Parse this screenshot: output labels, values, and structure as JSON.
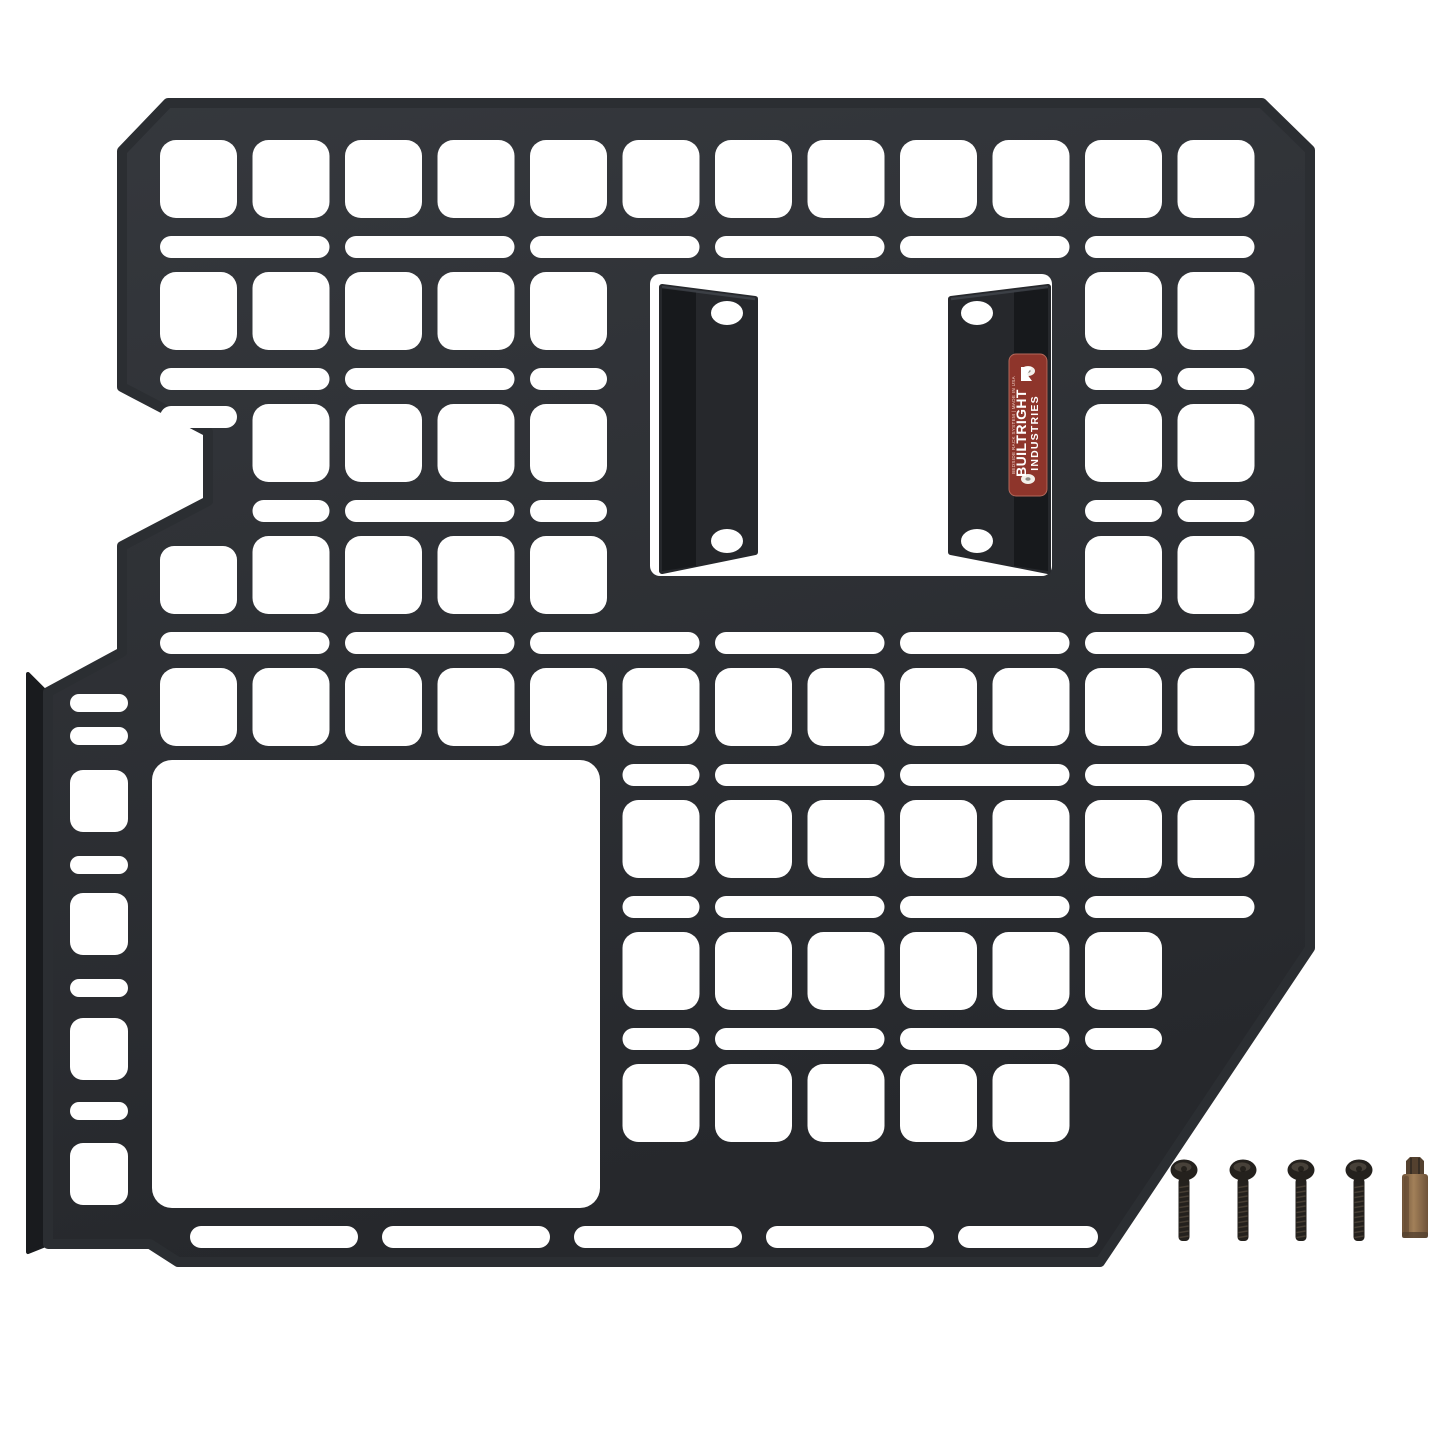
{
  "scene": {
    "alt": "Black laser-cut MOLLE bedside rack panel with two mounting brackets, red BuiltRight Industries badge, four black screws and one Torx bit on a white background",
    "bg": "#ffffff",
    "width": 1445,
    "height": 1444
  },
  "colors": {
    "panel_top": "#35383d",
    "panel_bottom": "#26282c",
    "panel_stroke": "#2b2e32",
    "flange": "#191b1e",
    "bracket": "#26282c",
    "bracket_web": "#17191c",
    "bracket_edge": "#474c53",
    "cutout": "#ffffff",
    "badge_bg": "#8e352b",
    "badge_border": "#b4685a",
    "badge_text": "#ffffff",
    "badge_smallprint": "#eecfc6",
    "rivet": "#f2efe9",
    "rivet_center": "#8e8a84",
    "screw": "#24211d",
    "screw_hl": "#6a6156",
    "screw_recess": "#0d0c0a",
    "thread": "#4e4438",
    "bit_light": "#a28059",
    "bit_dark": "#6e5238",
    "bit_tip": "#54412f",
    "bit_shade": "#5f4630"
  },
  "panel": {
    "outline": [
      [
        168,
        103
      ],
      [
        1262,
        103
      ],
      [
        1310,
        150
      ],
      [
        1310,
        948
      ],
      [
        1100,
        1262
      ],
      [
        178,
        1262
      ],
      [
        150,
        1244
      ],
      [
        48,
        1244
      ],
      [
        48,
        692
      ],
      [
        122,
        652
      ],
      [
        122,
        546
      ],
      [
        208,
        501
      ],
      [
        208,
        432
      ],
      [
        122,
        387
      ],
      [
        122,
        151
      ]
    ],
    "flange": [
      [
        28,
        674
      ],
      [
        48,
        694
      ],
      [
        48,
        1244
      ],
      [
        28,
        1252
      ]
    ]
  },
  "grid": {
    "col_x0": 160,
    "col_pitch": 92.5,
    "sq_w": 77,
    "sq_h": 78,
    "sq_r": 16,
    "slot_h": 22,
    "slot_r": 11,
    "pair_w": 169.5,
    "square_rows": [
      {
        "y": 140,
        "cols": [
          1,
          2,
          3,
          4,
          5,
          6,
          7,
          8,
          9,
          10,
          11,
          12
        ]
      },
      {
        "y": 272,
        "cols": [
          1,
          2,
          3,
          4,
          5,
          11,
          12
        ]
      },
      {
        "y": 404,
        "cols": [
          2,
          3,
          4,
          5,
          11,
          12
        ]
      },
      {
        "y": 536,
        "cols": [
          2,
          3,
          4,
          5,
          11,
          12
        ]
      },
      {
        "y": 668,
        "cols": [
          1,
          2,
          3,
          4,
          5,
          6,
          7,
          8,
          9,
          10,
          11,
          12
        ]
      },
      {
        "y": 800,
        "cols": [
          6,
          7,
          8,
          9,
          10,
          11,
          12
        ]
      },
      {
        "y": 932,
        "cols": [
          6,
          7,
          8,
          9,
          10,
          11
        ]
      },
      {
        "y": 1064,
        "cols": [
          6,
          7,
          8,
          9,
          10
        ]
      }
    ],
    "special_squares": [
      {
        "x": 160,
        "y": 546,
        "w": 77,
        "h": 68,
        "r": 14
      }
    ],
    "slot_rows": [
      {
        "y": 236,
        "runs": [
          [
            1,
            2
          ],
          [
            3,
            2
          ],
          [
            5,
            2
          ],
          [
            7,
            2
          ],
          [
            9,
            2
          ],
          [
            11,
            2
          ]
        ]
      },
      {
        "y": 368,
        "runs": [
          [
            1,
            2
          ],
          [
            3,
            2
          ],
          [
            5,
            1
          ],
          [
            11,
            1
          ],
          [
            12,
            1
          ]
        ]
      },
      {
        "y": 406,
        "runs": [
          [
            1,
            1
          ]
        ]
      },
      {
        "y": 500,
        "runs": [
          [
            2,
            1
          ],
          [
            3,
            2
          ],
          [
            5,
            1
          ],
          [
            11,
            1
          ],
          [
            12,
            1
          ]
        ]
      },
      {
        "y": 632,
        "runs": [
          [
            1,
            2
          ],
          [
            3,
            2
          ],
          [
            5,
            2
          ],
          [
            7,
            2
          ],
          [
            9,
            2
          ],
          [
            11,
            2
          ]
        ]
      },
      {
        "y": 764,
        "runs": [
          [
            6,
            1
          ],
          [
            7,
            2
          ],
          [
            9,
            2
          ],
          [
            11,
            2
          ]
        ]
      },
      {
        "y": 896,
        "runs": [
          [
            6,
            1
          ],
          [
            7,
            2
          ],
          [
            9,
            2
          ],
          [
            11,
            2
          ]
        ]
      },
      {
        "y": 1028,
        "runs": [
          [
            6,
            1
          ],
          [
            7,
            2
          ],
          [
            9,
            2
          ],
          [
            11,
            1
          ]
        ]
      }
    ],
    "bottom_slots": {
      "y": 1226,
      "h": 22,
      "r": 11,
      "xs": [
        190,
        382,
        574,
        766,
        958
      ],
      "w": 168,
      "last_w": 140
    },
    "left_column": {
      "x": 70,
      "w": 58,
      "slot_h": 18,
      "slot_r": 9,
      "slot_ys": [
        694,
        727,
        856,
        979,
        1102
      ],
      "sq_h": 62,
      "sq_r": 13,
      "square_ys": [
        770,
        893,
        1018,
        1143
      ]
    },
    "windows": {
      "bracket": {
        "x": 650,
        "y": 274,
        "w": 402,
        "h": 302,
        "r": 10
      },
      "large": {
        "x": 152,
        "y": 760,
        "w": 448,
        "h": 448,
        "r": 20
      }
    }
  },
  "brackets": [
    {
      "name": "mounting-bracket-left",
      "outline": [
        [
          662,
          287
        ],
        [
          755,
          299
        ],
        [
          755,
          552
        ],
        [
          662,
          571
        ]
      ],
      "web": [
        [
          662,
          287
        ],
        [
          696,
          292
        ],
        [
          696,
          566
        ],
        [
          662,
          571
        ]
      ],
      "holes": [
        {
          "cx": 727,
          "cy": 313
        },
        {
          "cx": 727,
          "cy": 541
        }
      ]
    },
    {
      "name": "mounting-bracket-right",
      "outline": [
        [
          951,
          299
        ],
        [
          1048,
          287
        ],
        [
          1048,
          571
        ],
        [
          951,
          552
        ]
      ],
      "web": [
        [
          1014,
          292
        ],
        [
          1048,
          287
        ],
        [
          1048,
          571
        ],
        [
          1014,
          566
        ]
      ],
      "holes": [
        {
          "cx": 977,
          "cy": 313
        },
        {
          "cx": 977,
          "cy": 541
        }
      ]
    }
  ],
  "bracket_hole": {
    "rx": 16,
    "ry": 12
  },
  "badge": {
    "x": 1009,
    "y": 354,
    "w": 38,
    "h": 142,
    "r": 7,
    "cx": 1028,
    "cy": 425,
    "brand_line1": "BUILTRIGHT",
    "brand_line2": "INDUSTRIES",
    "small_print": "BEDSIDE RACK SYSTEM  |  MADE IN USA",
    "rivets": [
      {
        "cx": 1028,
        "cy": 371
      },
      {
        "cx": 1028,
        "cy": 479
      }
    ]
  },
  "hardware": {
    "screw_count": 4,
    "bit_count": 1,
    "screws": {
      "cx": [
        1184,
        1243,
        1301,
        1359
      ],
      "head_cy": 1170,
      "head_rx": 13.5,
      "head_ry": 10.5,
      "shaft_w": 11,
      "shaft_top": 1178,
      "shaft_bot": 1241
    },
    "bit": {
      "cx": 1415,
      "body_w": 26,
      "body_top": 1174,
      "body_bot": 1238,
      "tip_w": 18,
      "tip_top": 1157
    }
  }
}
